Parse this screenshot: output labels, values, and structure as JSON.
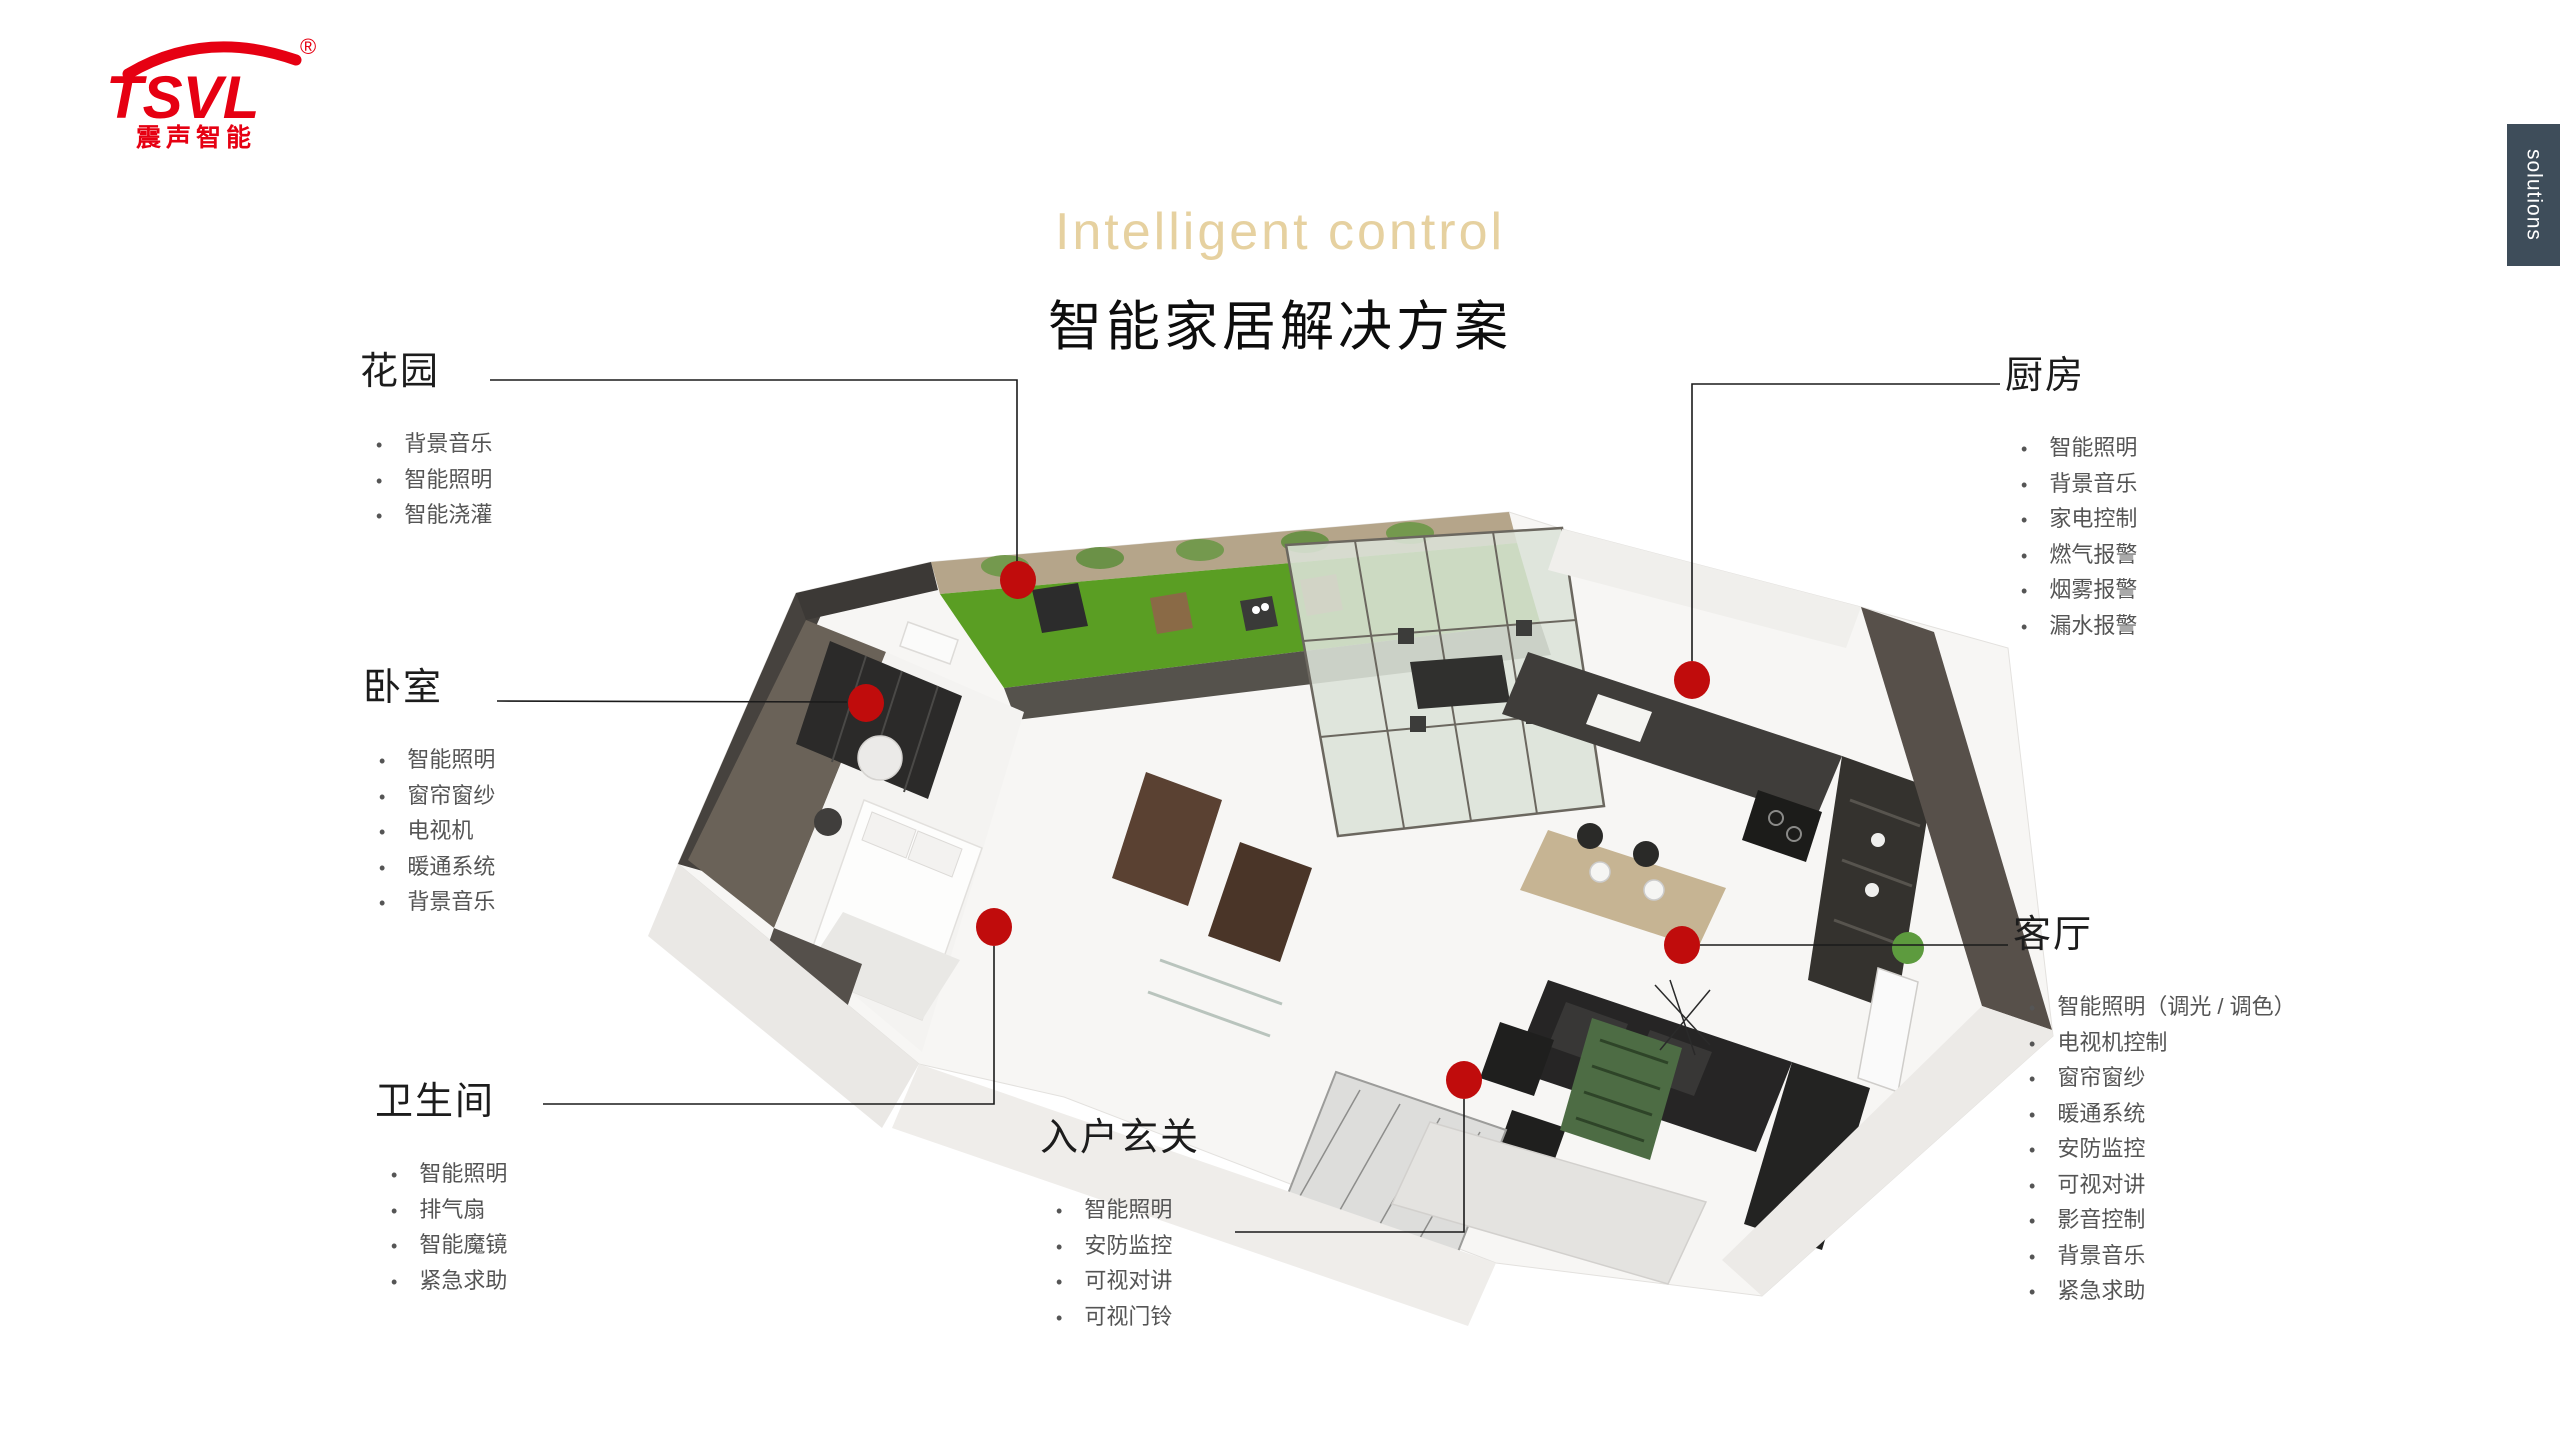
{
  "logo": {
    "brand": "TSVL",
    "registered": "®",
    "subtitle": "震声智能"
  },
  "title": {
    "en": "Intelligent control",
    "zh": "智能家居解决方案"
  },
  "side_tab": {
    "label": "solutions"
  },
  "sections": {
    "garden": {
      "title": "花园",
      "items": [
        "背景音乐",
        "智能照明",
        "智能浇灌"
      ]
    },
    "bedroom": {
      "title": "卧室",
      "items": [
        "智能照明",
        "窗帘窗纱",
        "电视机",
        "暖通系统",
        "背景音乐"
      ]
    },
    "bathroom": {
      "title": "卫生间",
      "items": [
        "智能照明",
        "排气扇",
        "智能魔镜",
        "紧急求助"
      ]
    },
    "entrance": {
      "title": "入户玄关",
      "items": [
        "智能照明",
        "安防监控",
        "可视对讲",
        "可视门铃"
      ]
    },
    "kitchen": {
      "title": "厨房",
      "items": [
        "智能照明",
        "背景音乐",
        "家电控制",
        "燃气报警",
        "烟雾报警",
        "漏水报警"
      ]
    },
    "living": {
      "title": "客厅",
      "items": [
        "智能照明（调光 / 调色）",
        "电视机控制",
        "窗帘窗纱",
        "暖通系统",
        "安防监控",
        "可视对讲",
        "影音控制",
        "背景音乐",
        "紧急求助"
      ]
    }
  },
  "colors": {
    "accent_red": "#c00c0c",
    "logo_red": "#e60012",
    "title_beige": "#e6d1a0",
    "tab_bg": "#3e4d5a",
    "heading_text": "#1c1c1c",
    "list_text": "#555555"
  }
}
